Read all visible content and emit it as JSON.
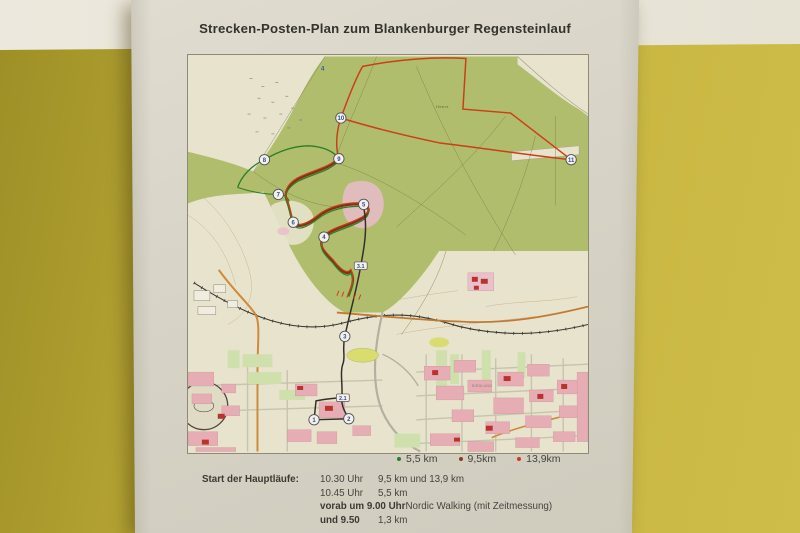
{
  "poster": {
    "title": "Strecken-Posten-Plan zum Blankenburger Regensteinlauf"
  },
  "legend": {
    "items": [
      {
        "label": "5,5 km",
        "color": "#2e7d2a"
      },
      {
        "label": "9,5km",
        "color": "#84401f"
      },
      {
        "label": "13,9km",
        "color": "#c73f17"
      }
    ]
  },
  "schedule": {
    "heading": "Start der Hauptläufe:",
    "line1_time": "10.30 Uhr",
    "line1_dist": "9,5 km und 13,9 km",
    "line2_time": "10.45 Uhr",
    "line2_dist": "5,5 km",
    "line3_bold": "vorab um 9.00 Uhr",
    "line3_rest": " Nordic Walking (mit Zeitmessung)",
    "line4_bold": "und 9.50",
    "line4_dist": "1,3 km"
  },
  "map": {
    "route_colors": {
      "long_13_9": "#c8401a",
      "mid_9_5": "#7e3318",
      "short_5_5": "#2e7d2a",
      "link": "#33302a"
    },
    "posts": [
      {
        "n": "1",
        "x": 127,
        "y": 366
      },
      {
        "n": "2",
        "x": 162,
        "y": 365
      },
      {
        "n": "3",
        "x": 158,
        "y": 282
      },
      {
        "n": "4",
        "x": 137,
        "y": 182
      },
      {
        "n": "5",
        "x": 177,
        "y": 149
      },
      {
        "n": "6",
        "x": 106,
        "y": 167
      },
      {
        "n": "7",
        "x": 91,
        "y": 139
      },
      {
        "n": "8",
        "x": 77,
        "y": 104
      },
      {
        "n": "9",
        "x": 152,
        "y": 103
      },
      {
        "n": "10",
        "x": 154,
        "y": 62
      },
      {
        "n": "11",
        "x": 386,
        "y": 104
      }
    ],
    "waypoints": [
      {
        "t": "2.1",
        "x": 156,
        "y": 344
      },
      {
        "t": "3.1",
        "x": 174,
        "y": 211
      }
    ],
    "area_labels": [
      {
        "t": "4",
        "x": 134,
        "y": 14,
        "s": 6,
        "c": "#3a55a0",
        "b": true
      },
      {
        "t": "Heers",
        "x": 250,
        "y": 52,
        "s": 4,
        "c": "#5d6b3c",
        "b": false
      },
      {
        "t": "SIEDLUNG",
        "x": 286,
        "y": 333,
        "s": 3.4,
        "c": "#77776a",
        "b": false
      }
    ]
  }
}
